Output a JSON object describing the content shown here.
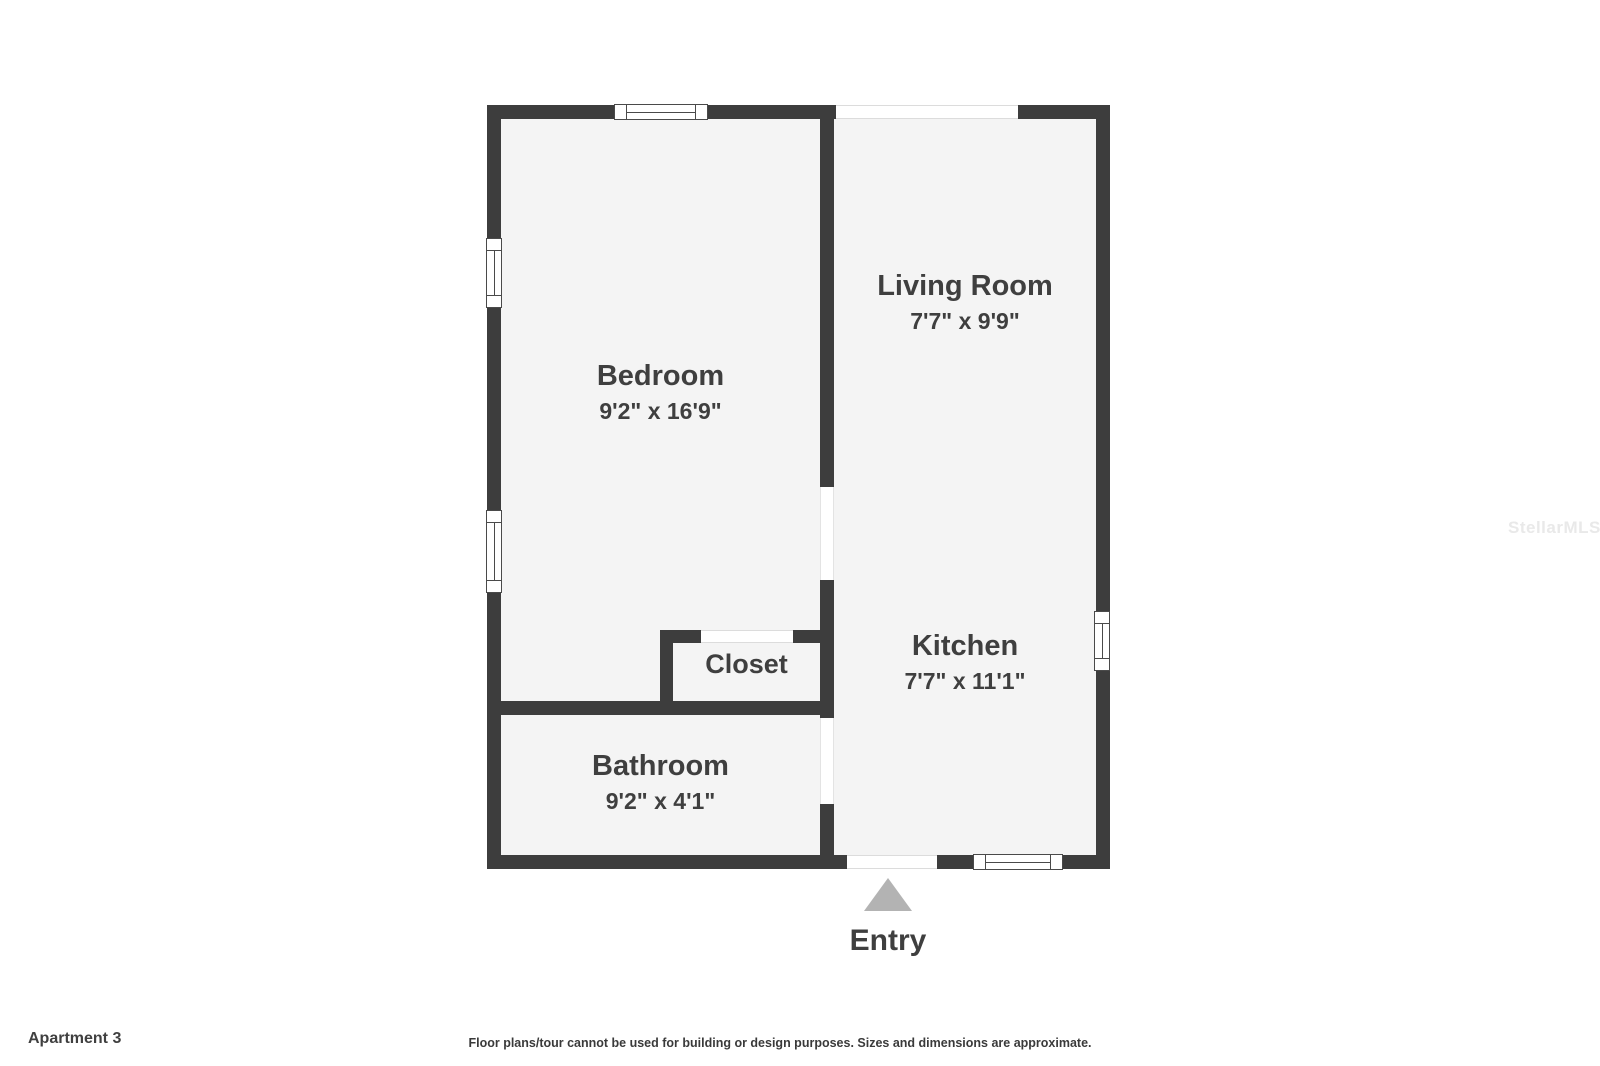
{
  "footer": {
    "title": "Apartment 3",
    "disclaimer": "Floor plans/tour cannot be used for building or design purposes. Sizes and dimensions are approximate."
  },
  "watermark": {
    "text": "StellarMLS"
  },
  "entry": {
    "label": "Entry"
  },
  "rooms": [
    {
      "name": "Bedroom",
      "dims": "9'2\" x 16'9\""
    },
    {
      "name": "Living Room",
      "dims": "7'7\" x 9'9\""
    },
    {
      "name": "Kitchen",
      "dims": "7'7\" x 11'1\""
    },
    {
      "name": "Closet",
      "dims": ""
    },
    {
      "name": "Bathroom",
      "dims": "9'2\" x 4'1\""
    }
  ],
  "colors": {
    "wall": "#3d3d3d",
    "floor": "#f4f4f4",
    "label": "#3f3f3f",
    "entry_arrow": "#b3b3b3",
    "watermark": "#e9e9e9"
  }
}
